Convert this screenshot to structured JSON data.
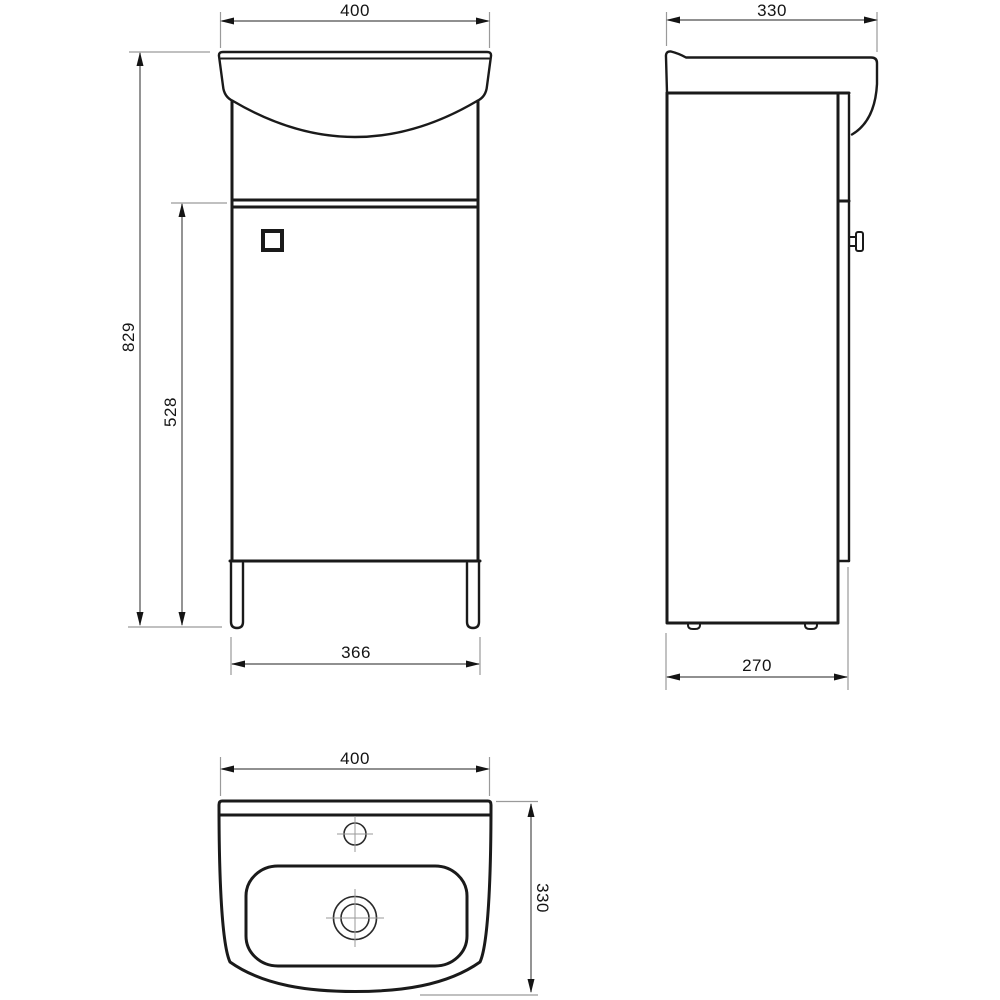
{
  "drawing": {
    "type": "technical-dimension-drawing",
    "subject": "vanity-unit-with-washbasin",
    "colors": {
      "background": "#ffffff",
      "object_line": "#1a1a1a",
      "dimension_line": "#4d4d4d",
      "extension_line": "#9a9a9a"
    },
    "views": {
      "front": {
        "label": "front-view",
        "dims": {
          "width": "400",
          "total_height": "829",
          "cabinet_height": "528",
          "leg_span": "366"
        }
      },
      "side": {
        "label": "side-view",
        "dims": {
          "depth": "330",
          "base_depth": "270"
        }
      },
      "plan": {
        "label": "plan-view",
        "dims": {
          "width": "400",
          "depth": "330"
        }
      }
    }
  }
}
